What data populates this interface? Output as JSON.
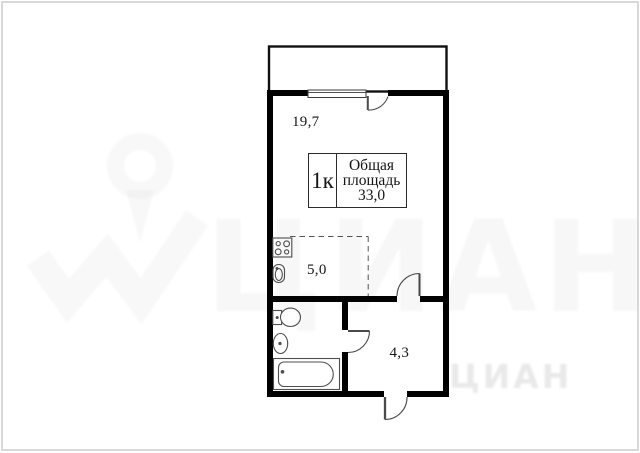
{
  "plan": {
    "info_box": {
      "rooms_label": "1к",
      "area_word1": "Общая",
      "area_word2": "площадь",
      "area_value": "33,0"
    },
    "room_areas": {
      "living_room": "19,7",
      "kitchen": "5,0",
      "hallway": "4,3"
    },
    "fixtures": [
      "stove",
      "kitchen-sink",
      "toilet",
      "wash-basin",
      "bathtub"
    ],
    "doors": [
      "balcony-door",
      "living-room-door",
      "bathroom-door",
      "entrance-door"
    ]
  },
  "watermark": {
    "brand_large": "ЦИАН",
    "brand_small": "ЦИАН"
  },
  "colors": {
    "wall": "#000000",
    "thin_line": "#4a4a4a",
    "frame_border": "#d9d9d9",
    "watermark_tint": "#f7f7f7"
  }
}
